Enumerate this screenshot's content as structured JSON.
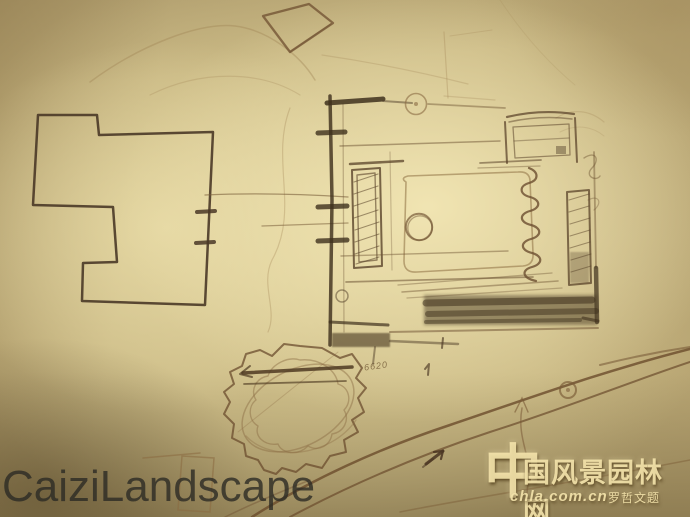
{
  "annotation": {
    "text": "6620"
  },
  "watermark_left": {
    "text": "CaiziLandscape",
    "color": "#2c2a24"
  },
  "watermark_right": {
    "logo_char": "中",
    "site_name": "国风景园林网",
    "url": "chla.com.cn",
    "seal": "罗哲文题",
    "color": "#f3e3aa"
  },
  "colors": {
    "paper_base": "#c2b07c",
    "paper_highlight": "#f2e6b4",
    "paper_shadow": "#58492b",
    "ink_heavy": "#3f311d",
    "ink_dark": "#52402a",
    "ink_medium": "#6e5434",
    "ink_light": "#92764a",
    "ink_faint": "#a58c5e"
  }
}
